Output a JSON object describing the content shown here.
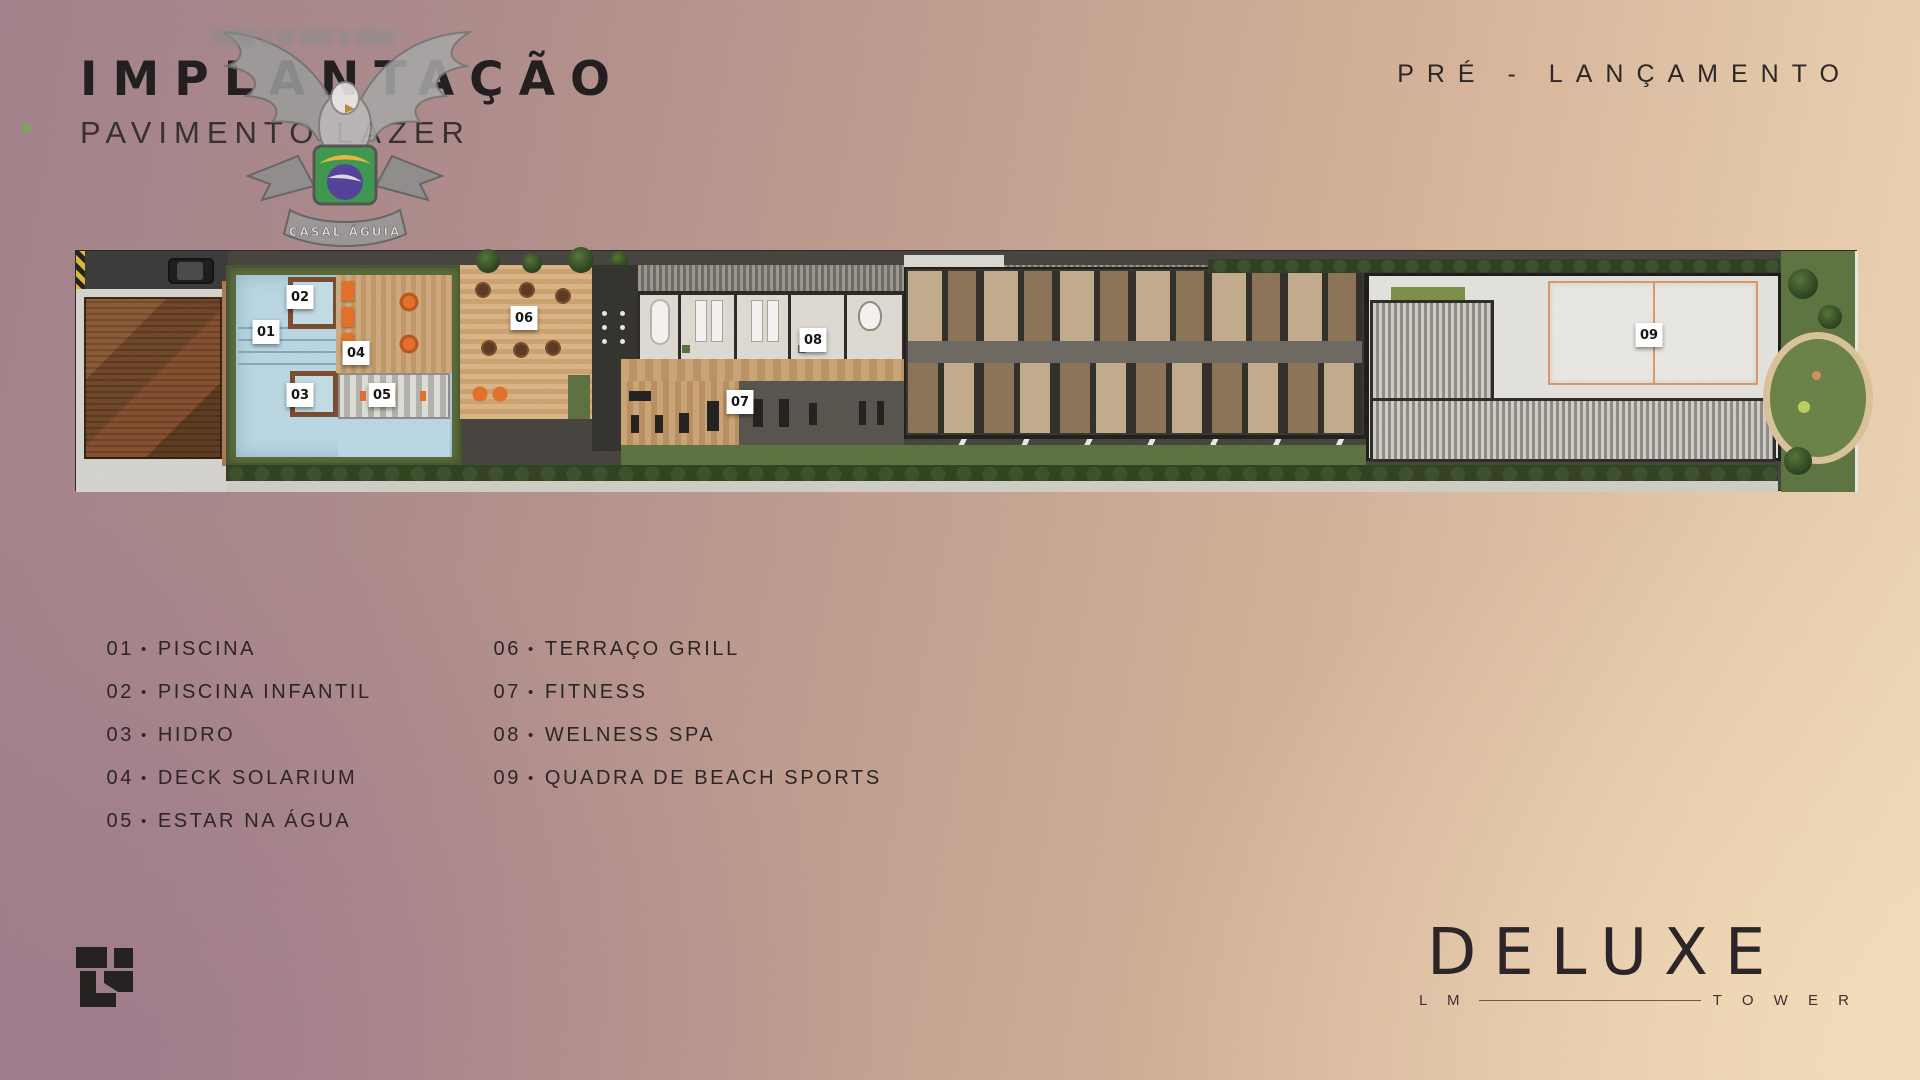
{
  "header": {
    "title": "IMPLANTAÇÃO",
    "subtitle": "PAVIMENTO LAZER",
    "pre_launch": "PRÉ - LANÇAMENTO"
  },
  "watermark": {
    "ribbon_text": "CASAL ÁGUIA"
  },
  "plan": {
    "markers": [
      "01",
      "02",
      "03",
      "04",
      "05",
      "06",
      "07",
      "08",
      "09"
    ]
  },
  "legend": {
    "separator": "•",
    "items": [
      {
        "num": "01",
        "label": "PISCINA"
      },
      {
        "num": "02",
        "label": "PISCINA INFANTIL"
      },
      {
        "num": "03",
        "label": "HIDRO"
      },
      {
        "num": "04",
        "label": "DECK SOLARIUM"
      },
      {
        "num": "05",
        "label": "ESTAR NA ÁGUA"
      },
      {
        "num": "06",
        "label": "TERRAÇO GRILL"
      },
      {
        "num": "07",
        "label": "FITNESS"
      },
      {
        "num": "08",
        "label": "WELNESS SPA"
      },
      {
        "num": "09",
        "label": "QUADRA DE BEACH SPORTS"
      }
    ]
  },
  "footer": {
    "brand": "DELUXE",
    "brand_sub_left": "L M",
    "brand_sub_right": "T O W E R"
  },
  "colors": {
    "accent_orange": "#e2702a",
    "court_line": "#dd9763",
    "pool_water": "#b9d6e2",
    "deck_wood": "#cfa97d",
    "hedge_green": "#5c6d3d",
    "bg_left": "#a1828a",
    "bg_right": "#edd7b5",
    "text_dark": "#241f21"
  }
}
